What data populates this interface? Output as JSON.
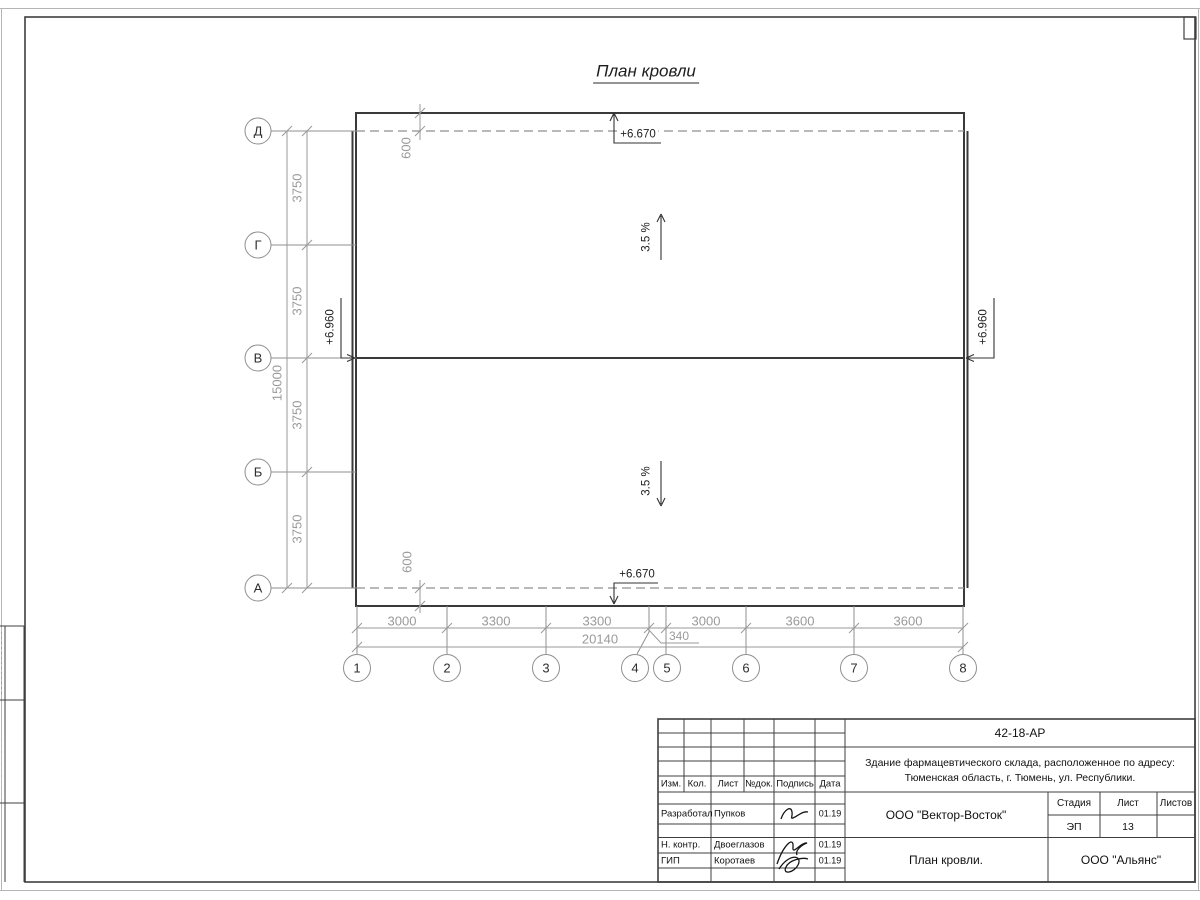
{
  "colors": {
    "line_dark": "#3f3f3f",
    "line_dim": "#9a9a9a",
    "text_dark": "#1d1d1d"
  },
  "sheet": {
    "title": "План кровли"
  },
  "plan": {
    "axes_vertical": [
      "Д",
      "Г",
      "В",
      "Б",
      "А"
    ],
    "axes_horizontal": [
      "1",
      "2",
      "3",
      "4",
      "5",
      "6",
      "7",
      "8"
    ],
    "dims_left_segments": [
      "3750",
      "3750",
      "3750",
      "3750"
    ],
    "dims_left_total": "15000",
    "dims_bottom_segments": [
      "3000",
      "3300",
      "3300",
      "340",
      "3000",
      "3600",
      "3600"
    ],
    "dims_bottom_total": "20140",
    "overhang_top": "600",
    "overhang_bottom": "600",
    "slope_top": "3.5 %",
    "slope_bottom": "3.5 %",
    "elev_top": "+6.670",
    "elev_bottom": "+6.670",
    "elev_ridge_left": "+6.960",
    "elev_ridge_right": "+6.960"
  },
  "title_block": {
    "doc_number": "42-18-АР",
    "description_line1": "Здание фармацевтического склада, расположенное по адресу:",
    "description_line2": "Тюменская область, г. Тюмень, ул. Республики.",
    "header_cols": [
      "Изм.",
      "Кол.",
      "Лист",
      "№док.",
      "Подпись",
      "Дата"
    ],
    "rows": [
      {
        "role": "Разработал",
        "name": "Пупков",
        "date": "01.19"
      },
      {
        "role": "Н. контр.",
        "name": "Двоеглазов",
        "date": "01.19"
      },
      {
        "role": "ГИП",
        "name": "Коротаев",
        "date": "01.19"
      }
    ],
    "contractor": "ООО \"Вектор-Восток\"",
    "stage_label": "Стадия",
    "sheet_label": "Лист",
    "sheets_label": "Листов",
    "stage_value": "ЭП",
    "sheet_value": "13",
    "drawing_title": "План кровли.",
    "company": "ООО \"Альянс\""
  }
}
